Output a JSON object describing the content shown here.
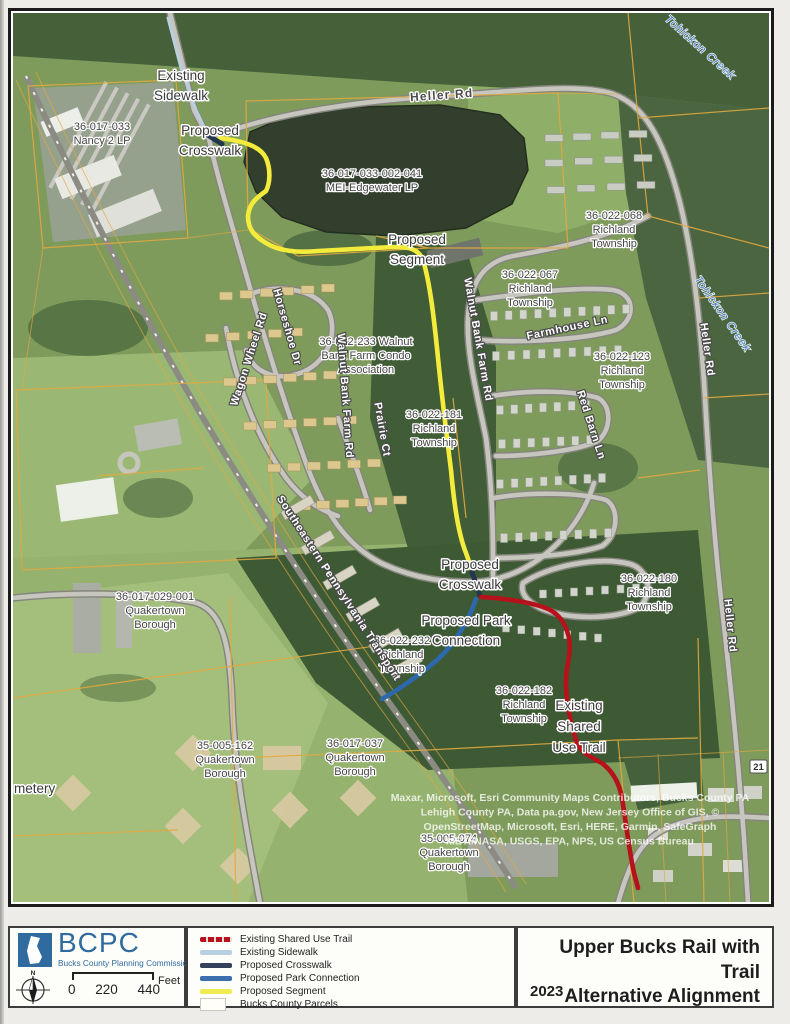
{
  "map": {
    "route_shield": "21",
    "labels": {
      "existing_sidewalk": [
        "Existing",
        "Sidewalk"
      ],
      "crosswalk_nw": [
        "Proposed",
        "Crosswalk"
      ],
      "nancy": [
        "36-017-033",
        "Nancy 2 LP"
      ],
      "heller_top": "Heller Rd",
      "mei": [
        "36-017-033-002-041",
        "MEI-Edgewater LP"
      ],
      "segment": [
        "Proposed",
        "Segment"
      ],
      "p68": [
        "36-022-068",
        "Richland",
        "Township"
      ],
      "p67": [
        "36-022-067",
        "Richland",
        "Township"
      ],
      "tohickon_ne": "Tohickon Creek",
      "walnut_e": "Walnut Bank Farm Rd",
      "farmhouse": "Farmhouse Ln",
      "p123": [
        "36-022-123",
        "Richland",
        "Township"
      ],
      "horseshoe": "Horseshoe Dr",
      "wagon": "Wagon Wheel Rd",
      "condo": [
        "36-022-233 Walnut",
        "Bank Farm Condo",
        "Association"
      ],
      "walnut_w": "Walnut Bank Farm Rd",
      "prairie": "Prairie Ct",
      "p181": [
        "36-022-181",
        "Richland",
        "Township"
      ],
      "redbarn": "Red Barn Ln",
      "heller_r1": "Heller Rd",
      "tohickon_r": "Tohickon Creek",
      "p29": [
        "36-017-029-001",
        "Quakertown",
        "Borough"
      ],
      "crosswalk_c": [
        "Proposed",
        "Crosswalk"
      ],
      "parkconn": [
        "Proposed Park",
        "Connection"
      ],
      "p232": [
        "36-022-232",
        "Richland",
        "Township"
      ],
      "p180": [
        "36-022-180",
        "Richland",
        "Township"
      ],
      "p182": [
        "36-022-182",
        "Richland",
        "Township"
      ],
      "trail_c": [
        "Existing",
        "Shared",
        "Use Trail"
      ],
      "p162": [
        "35-005-162",
        "Quakertown",
        "Borough"
      ],
      "p37": [
        "36-017-037",
        "Quakertown",
        "Borough"
      ],
      "p74": [
        "35-005-074",
        "Quakertown",
        "Borough"
      ],
      "cemetery": "metery",
      "septa": "Southeastern Pennsylvania Transport",
      "heller_r2": "Heller Rd",
      "attribution": [
        "Maxar, Microsoft, Esri Community Maps Contributors, Bucks County PA",
        "Lehigh County PA, Data pa.gov, New Jersey Office of GIS, ©",
        "OpenStreetMap, Microsoft, Esri, HERE, Garmin, SafeGraph",
        "METI/NASA, USGS, EPA, NPS, US Census Bureau"
      ]
    }
  },
  "legend": {
    "items": [
      {
        "key": "existing-shared-use-trail",
        "label": "Existing Shared Use Trail",
        "color": "#b5121b"
      },
      {
        "key": "existing-sidewalk",
        "label": "Existing Sidewalk",
        "color": "#b8cfdf"
      },
      {
        "key": "proposed-crosswalk",
        "label": "Proposed Crosswalk",
        "color": "#33415c"
      },
      {
        "key": "proposed-park-connection",
        "label": "Proposed Park Connection",
        "color": "#3c6fae"
      },
      {
        "key": "proposed-segment",
        "label": "Proposed Segment",
        "color": "#f0eb52"
      },
      {
        "key": "bucks-county-parcels",
        "label": "Bucks County Parcels",
        "color": "#fffef8"
      }
    ]
  },
  "footer": {
    "org_abbr": "BCPC",
    "org_name": "Bucks County Planning Commission",
    "compass_label": "N",
    "scale": {
      "start": "0",
      "mid": "220",
      "end": "440",
      "unit": "Feet"
    }
  },
  "title_block": {
    "line1": "Upper Bucks Rail with Trail",
    "line2": "Alternative Alignment",
    "year": "2023"
  }
}
